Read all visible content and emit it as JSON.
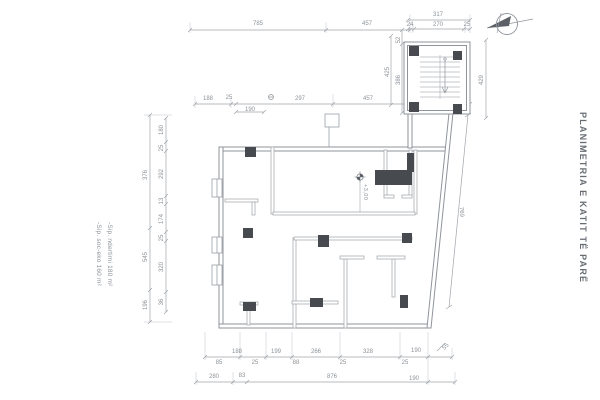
{
  "sheet": {
    "title": "PLANIMETRIA E KATIT TË PARË",
    "area_notes": [
      "-Sip. ndertimi 180 m²",
      "-Sip. soc-eko 160 m²"
    ],
    "level_marker": "+3,00"
  },
  "dimensions": {
    "top_row1": [
      "785",
      "457"
    ],
    "top_right": [
      "317",
      "24",
      "270",
      "25"
    ],
    "top_row2": [
      "188",
      "25",
      "297",
      "457"
    ],
    "top_row2_below": "190",
    "left_outer": [
      "376",
      "545",
      "196"
    ],
    "left_inner": [
      "180",
      "25",
      "292",
      "13",
      "174",
      "25",
      "320",
      "36"
    ],
    "stair_left": [
      "52",
      "425",
      "386"
    ],
    "right_outer": "429",
    "right_slant": "769",
    "bottom_row1": [
      "188",
      "199",
      "266",
      "328",
      "190",
      "55"
    ],
    "bottom_row1_below": [
      "85",
      "25",
      "88",
      "25",
      "25"
    ],
    "bottom_row2": [
      "280",
      "83",
      "876",
      "190"
    ]
  },
  "icons": {
    "north_arrow": "north-arrow-icon",
    "level_marker": "level-marker-icon",
    "stair_direction": "down-arrow-icon"
  },
  "colors": {
    "line": "#9aa0a6",
    "wall": "#8f949b",
    "column": "#474b50",
    "dim_text": "#8d9298",
    "title_text": "#686d74"
  }
}
